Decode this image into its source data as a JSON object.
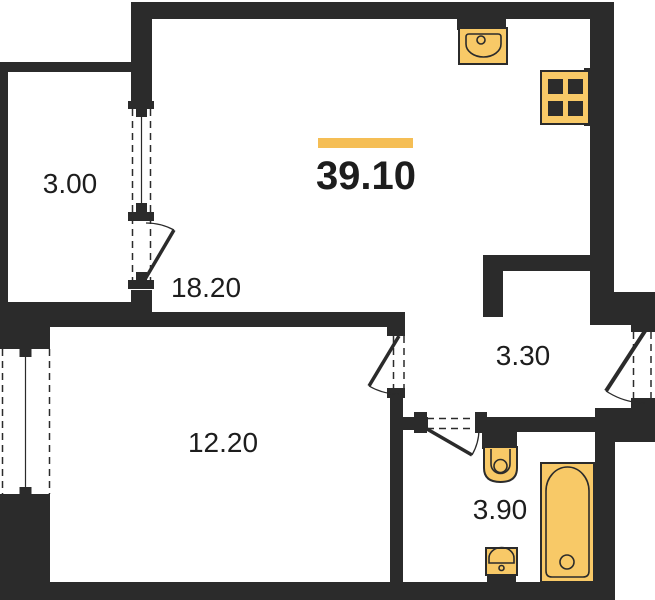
{
  "colors": {
    "wall": "#2b2b2b",
    "fixture_fill": "#F8C967",
    "accent_bar": "#F5BE55",
    "label_text": "#1d1d1d",
    "background": "#ffffff"
  },
  "title": {
    "total_area": "39.10"
  },
  "rooms": {
    "living_kitchen": {
      "area": "18.20"
    },
    "bedroom": {
      "area": "12.20"
    },
    "balcony": {
      "area": "3.00"
    },
    "hallway": {
      "area": "3.30"
    },
    "bathroom": {
      "area": "3.90"
    }
  },
  "fixtures": {
    "kitchen_sink": "kitchen-sink-icon",
    "stove": "stove-icon",
    "toilet": "toilet-icon",
    "washbasin": "washbasin-icon",
    "bathtub": "bathtub-icon"
  }
}
